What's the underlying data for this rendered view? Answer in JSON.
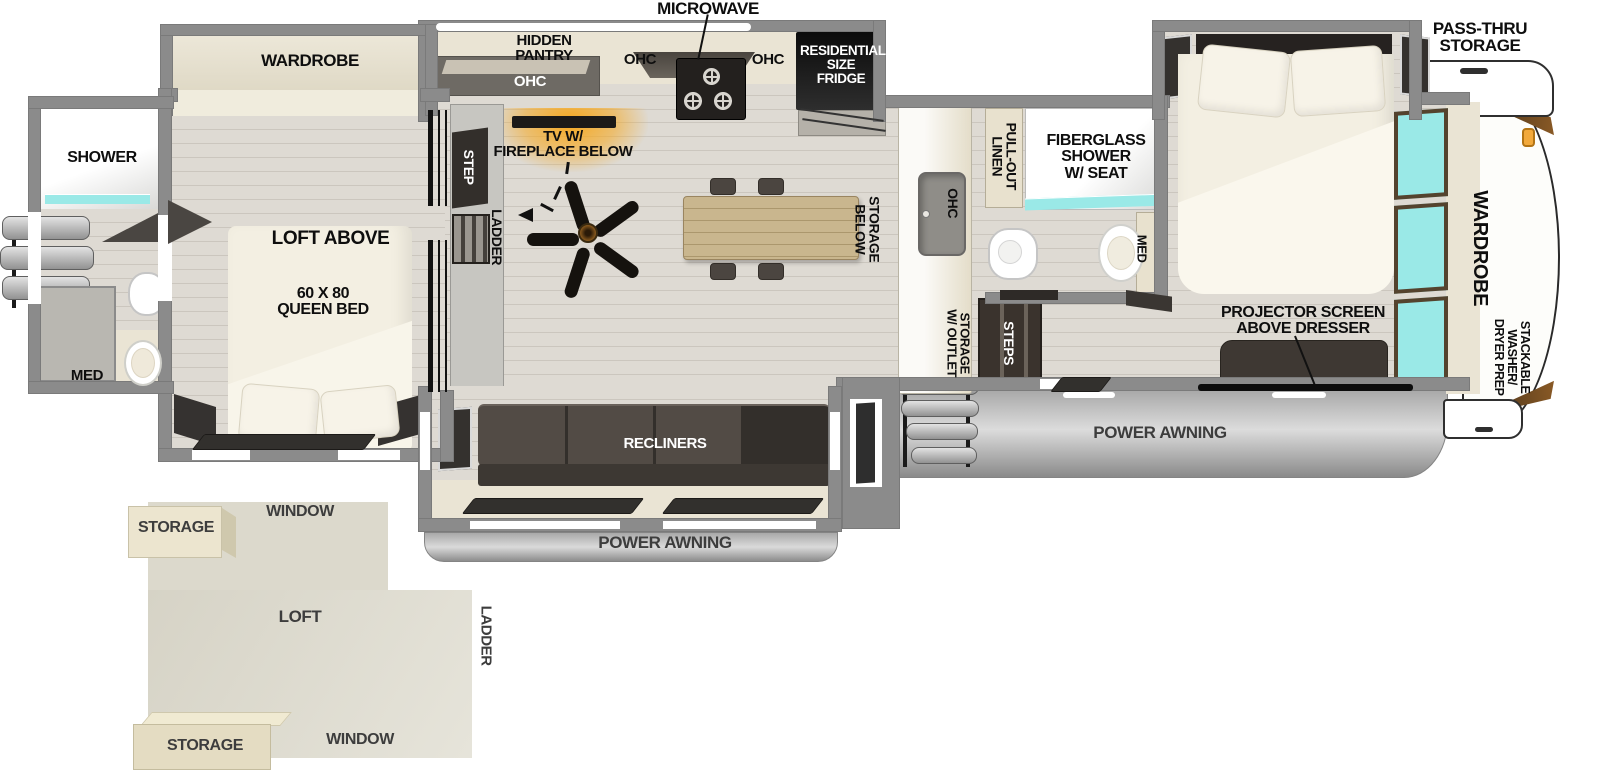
{
  "colors": {
    "wall_gray": "#8b8b8b",
    "floor_wood": "#dad6cf",
    "counter_beige": "#eae4d4",
    "furniture_dark": "#453f3a",
    "label_black": "#0e0e0e",
    "glass_cyan": "#9ae9e7",
    "fireplace_orange": "#f4a21f",
    "awning_gray": "#c2c2c2",
    "cap_accent_brown": "#6e4b22",
    "cap_handle_orange": "#f2a93b"
  },
  "kitchen": {
    "microwave": "MICROWAVE",
    "hidden_pantry": "HIDDEN\nPANTRY",
    "ohc_pantry": "OHC",
    "ohc_left": "OHC",
    "ohc_right": "OHC",
    "fridge": "RESIDENTIAL\nSIZE\nFRIDGE",
    "island_ohc": "OHC",
    "storage_below": "STORAGE\nBELOW",
    "storage_outlet": "STORAGE\nW/ OUTLET"
  },
  "living": {
    "tv_fireplace": "TV W/\nFIREPLACE BELOW",
    "step": "STEP",
    "ladder": "LADDER",
    "steps": "STEPS",
    "recliners": "RECLINERS"
  },
  "mid_bath": {
    "pull_out_linen": "PULL-OUT\nLINEN",
    "fiberglass_shower": "FIBERGLASS\nSHOWER\nW/ SEAT",
    "med": "MED"
  },
  "front_bedroom": {
    "projector": "PROJECTOR SCREEN\nABOVE DRESSER",
    "wardrobe": "WARDROBE",
    "stackable": "STACKABLE WASHER/\nDRYER PREP"
  },
  "rear_bedroom": {
    "wardrobe": "WARDROBE",
    "loft_above": "LOFT ABOVE",
    "queen_bed": "60 X 80\nQUEEN BED"
  },
  "rear_bath": {
    "shower": "SHOWER",
    "med": "MED"
  },
  "exterior": {
    "pass_thru": "PASS-THRU\nSTORAGE",
    "awning_left": "POWER AWNING",
    "awning_right": "POWER AWNING"
  },
  "loft_inset": {
    "storage_top": "STORAGE",
    "window_top": "WINDOW",
    "loft": "LOFT",
    "ladder": "LADDER",
    "window_bottom": "WINDOW",
    "storage_bottom": "STORAGE"
  }
}
